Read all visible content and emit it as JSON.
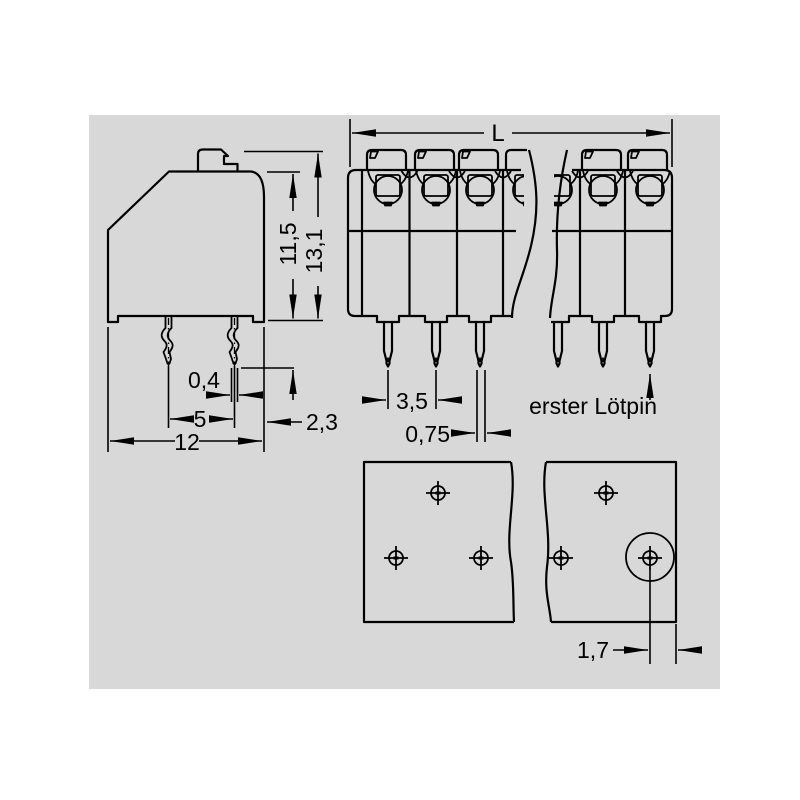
{
  "colors": {
    "page_background": "#ffffff",
    "panel_background": "#d8d8d8",
    "line": "#000000"
  },
  "views": {
    "side": {
      "dims": {
        "height_body": "11,5",
        "height_total": "13,1",
        "pin_thickness": "0,4",
        "row_spacing": "5",
        "depth": "12",
        "rear_offset": "2,3"
      }
    },
    "front": {
      "dims": {
        "length": "L",
        "pitch": "3,5",
        "pin_width": "0,75"
      },
      "annotation_first_pin": "erster Lötpin"
    },
    "footprint": {
      "dims": {
        "hole_edge_offset": "1,7"
      }
    }
  }
}
